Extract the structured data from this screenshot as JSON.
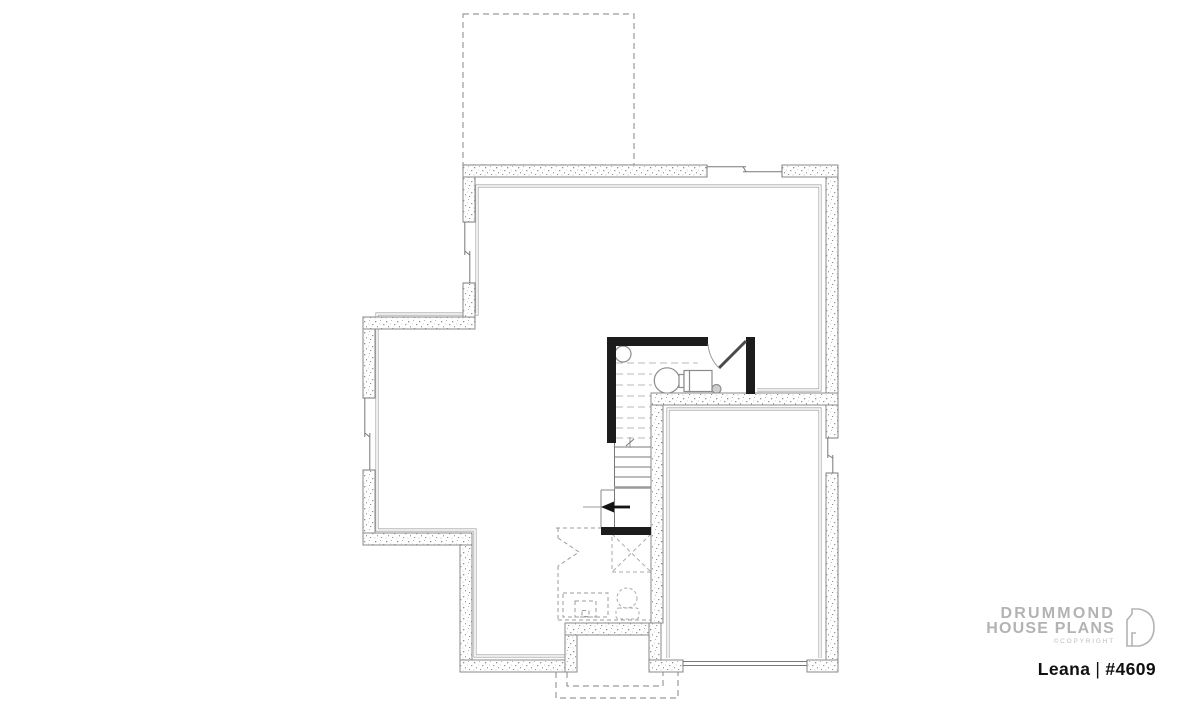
{
  "branding": {
    "line1": "DRUMMOND",
    "line2": "HOUSE PLANS",
    "copyright": "©COPYRIGHT"
  },
  "plan": {
    "name": "Leana",
    "separator": "|",
    "number": "#4609"
  },
  "colors": {
    "background": "#ffffff",
    "wall_outline": "#8a8a8a",
    "wall_speckle": "#979797",
    "interior_finish_line": "#ababab",
    "black_partition": "#1c1c1c",
    "dashed_outline": "#9b9b9b",
    "stair_dashed": "#b8b8b8",
    "fixture_outline": "#8c8c8c",
    "logo_gray": "#b3b3b3",
    "title_color": "#101010"
  },
  "icons": {
    "floor_drain": "small-circle",
    "water_heater": "large-circle",
    "furnace": "rectangle",
    "stair_direction": "left-arrow",
    "toilet": "circle-with-tank",
    "vanity_sink": "nested-dashed-squares",
    "door_swing": "arc",
    "window": "double-line",
    "concrete_wall": "speckled-band"
  }
}
